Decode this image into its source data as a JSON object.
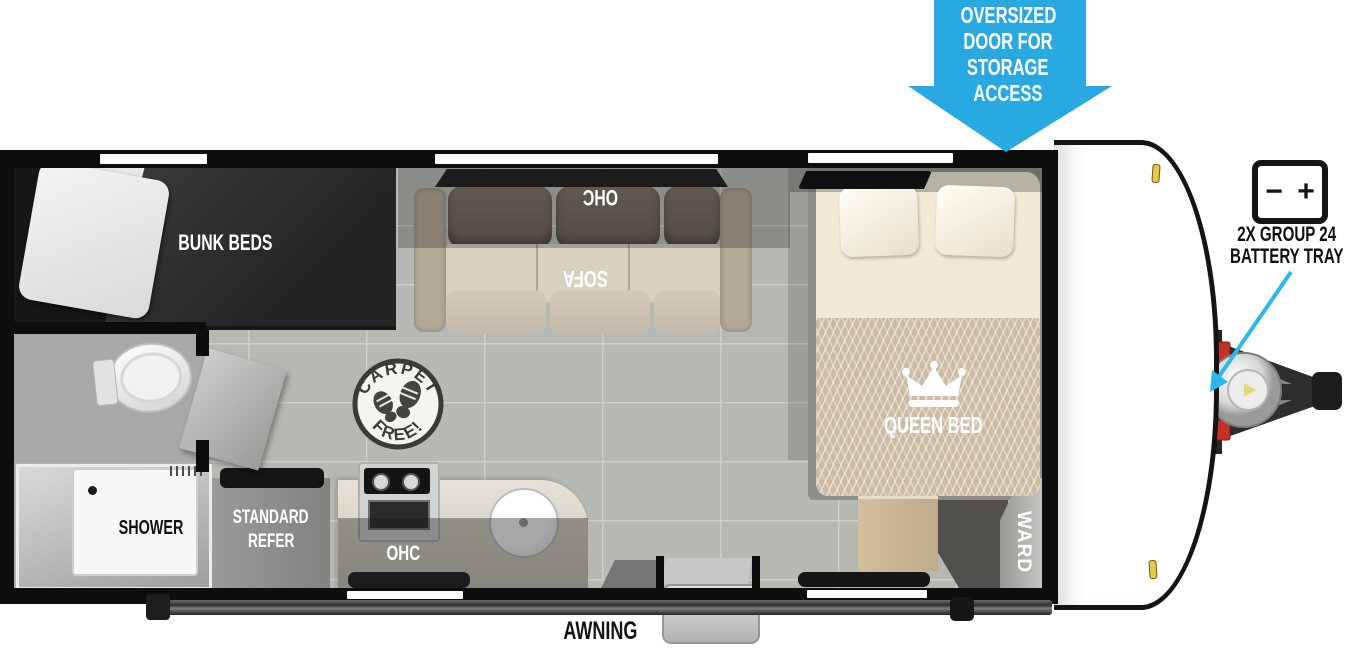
{
  "diagram": {
    "type": "travel-trailer floor plan"
  },
  "labels": {
    "bunk_beds": "BUNK BEDS",
    "sofa": "SOFA",
    "sofa_ohc": "OHC",
    "queen_bed": "QUEEN BED",
    "wardrobe": "WARD",
    "shower": "SHOWER",
    "refer_line1": "STANDARD",
    "refer_line2": "REFER",
    "kitchen_ohc": "OHC",
    "awning": "AWNING"
  },
  "callouts": {
    "storage_door": {
      "line1": "OVERSIZED",
      "line2": "DOOR FOR",
      "line3": "STORAGE",
      "line4": "ACCESS"
    },
    "battery_tray": {
      "line1": "2X GROUP 24",
      "line2": "BATTERY TRAY",
      "icon_minus": "−",
      "icon_plus": "+"
    }
  },
  "stamp": {
    "arc_top": "CARPET",
    "arc_bottom": "FREE!"
  },
  "colors": {
    "callout_blue": "#29a9e2",
    "pointer_cyan": "#2cb8ea",
    "battery_red": "#c43127",
    "clearance_yellow": "#e8c84a",
    "wall_black": "#0d0d0d"
  }
}
